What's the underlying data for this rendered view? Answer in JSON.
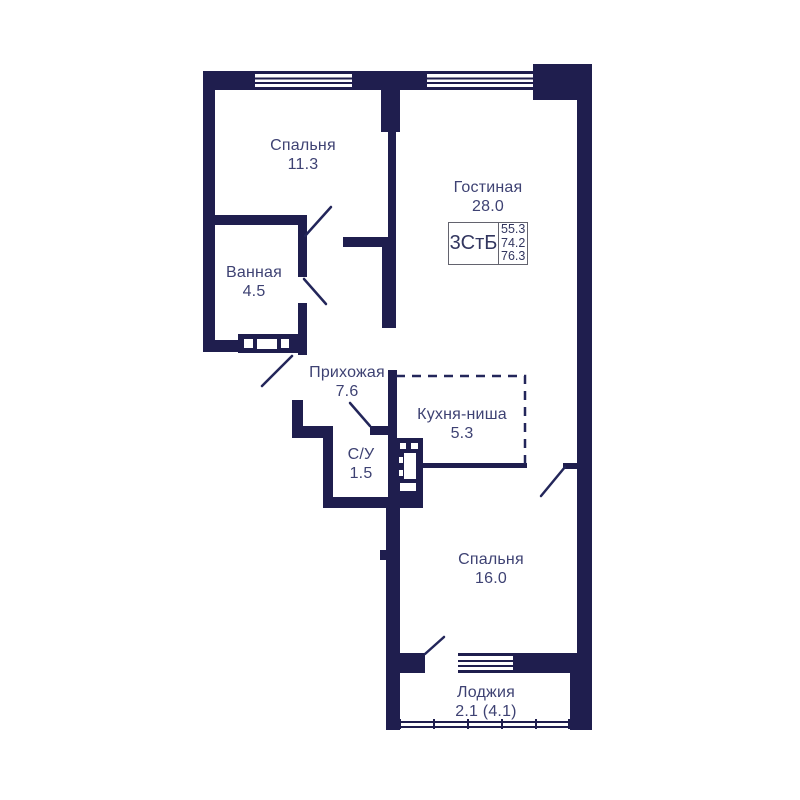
{
  "plan": {
    "title": "apartment-floor-plan",
    "rooms": [
      {
        "id": "bedroom-1",
        "name": "Спальня",
        "area": "11.3"
      },
      {
        "id": "living",
        "name": "Гостиная",
        "area": "28.0"
      },
      {
        "id": "bathroom",
        "name": "Ванная",
        "area": "4.5"
      },
      {
        "id": "hallway",
        "name": "Прихожая",
        "area": "7.6"
      },
      {
        "id": "kitchen",
        "name": "Кухня-ниша",
        "area": "5.3"
      },
      {
        "id": "wc",
        "name": "С/У",
        "area": "1.5"
      },
      {
        "id": "bedroom-2",
        "name": "Спальня",
        "area": "16.0"
      },
      {
        "id": "loggia",
        "name": "Лоджия",
        "area": "2.1 (4.1)"
      }
    ],
    "info_box": {
      "type_label": "3СтБ",
      "values": [
        "55.3",
        "74.2",
        "76.3"
      ]
    },
    "colors": {
      "wall": "#1f1e4e",
      "line": "#23265a",
      "text": "#3e4273",
      "box_border": "#63636e",
      "background": "#ffffff"
    }
  }
}
